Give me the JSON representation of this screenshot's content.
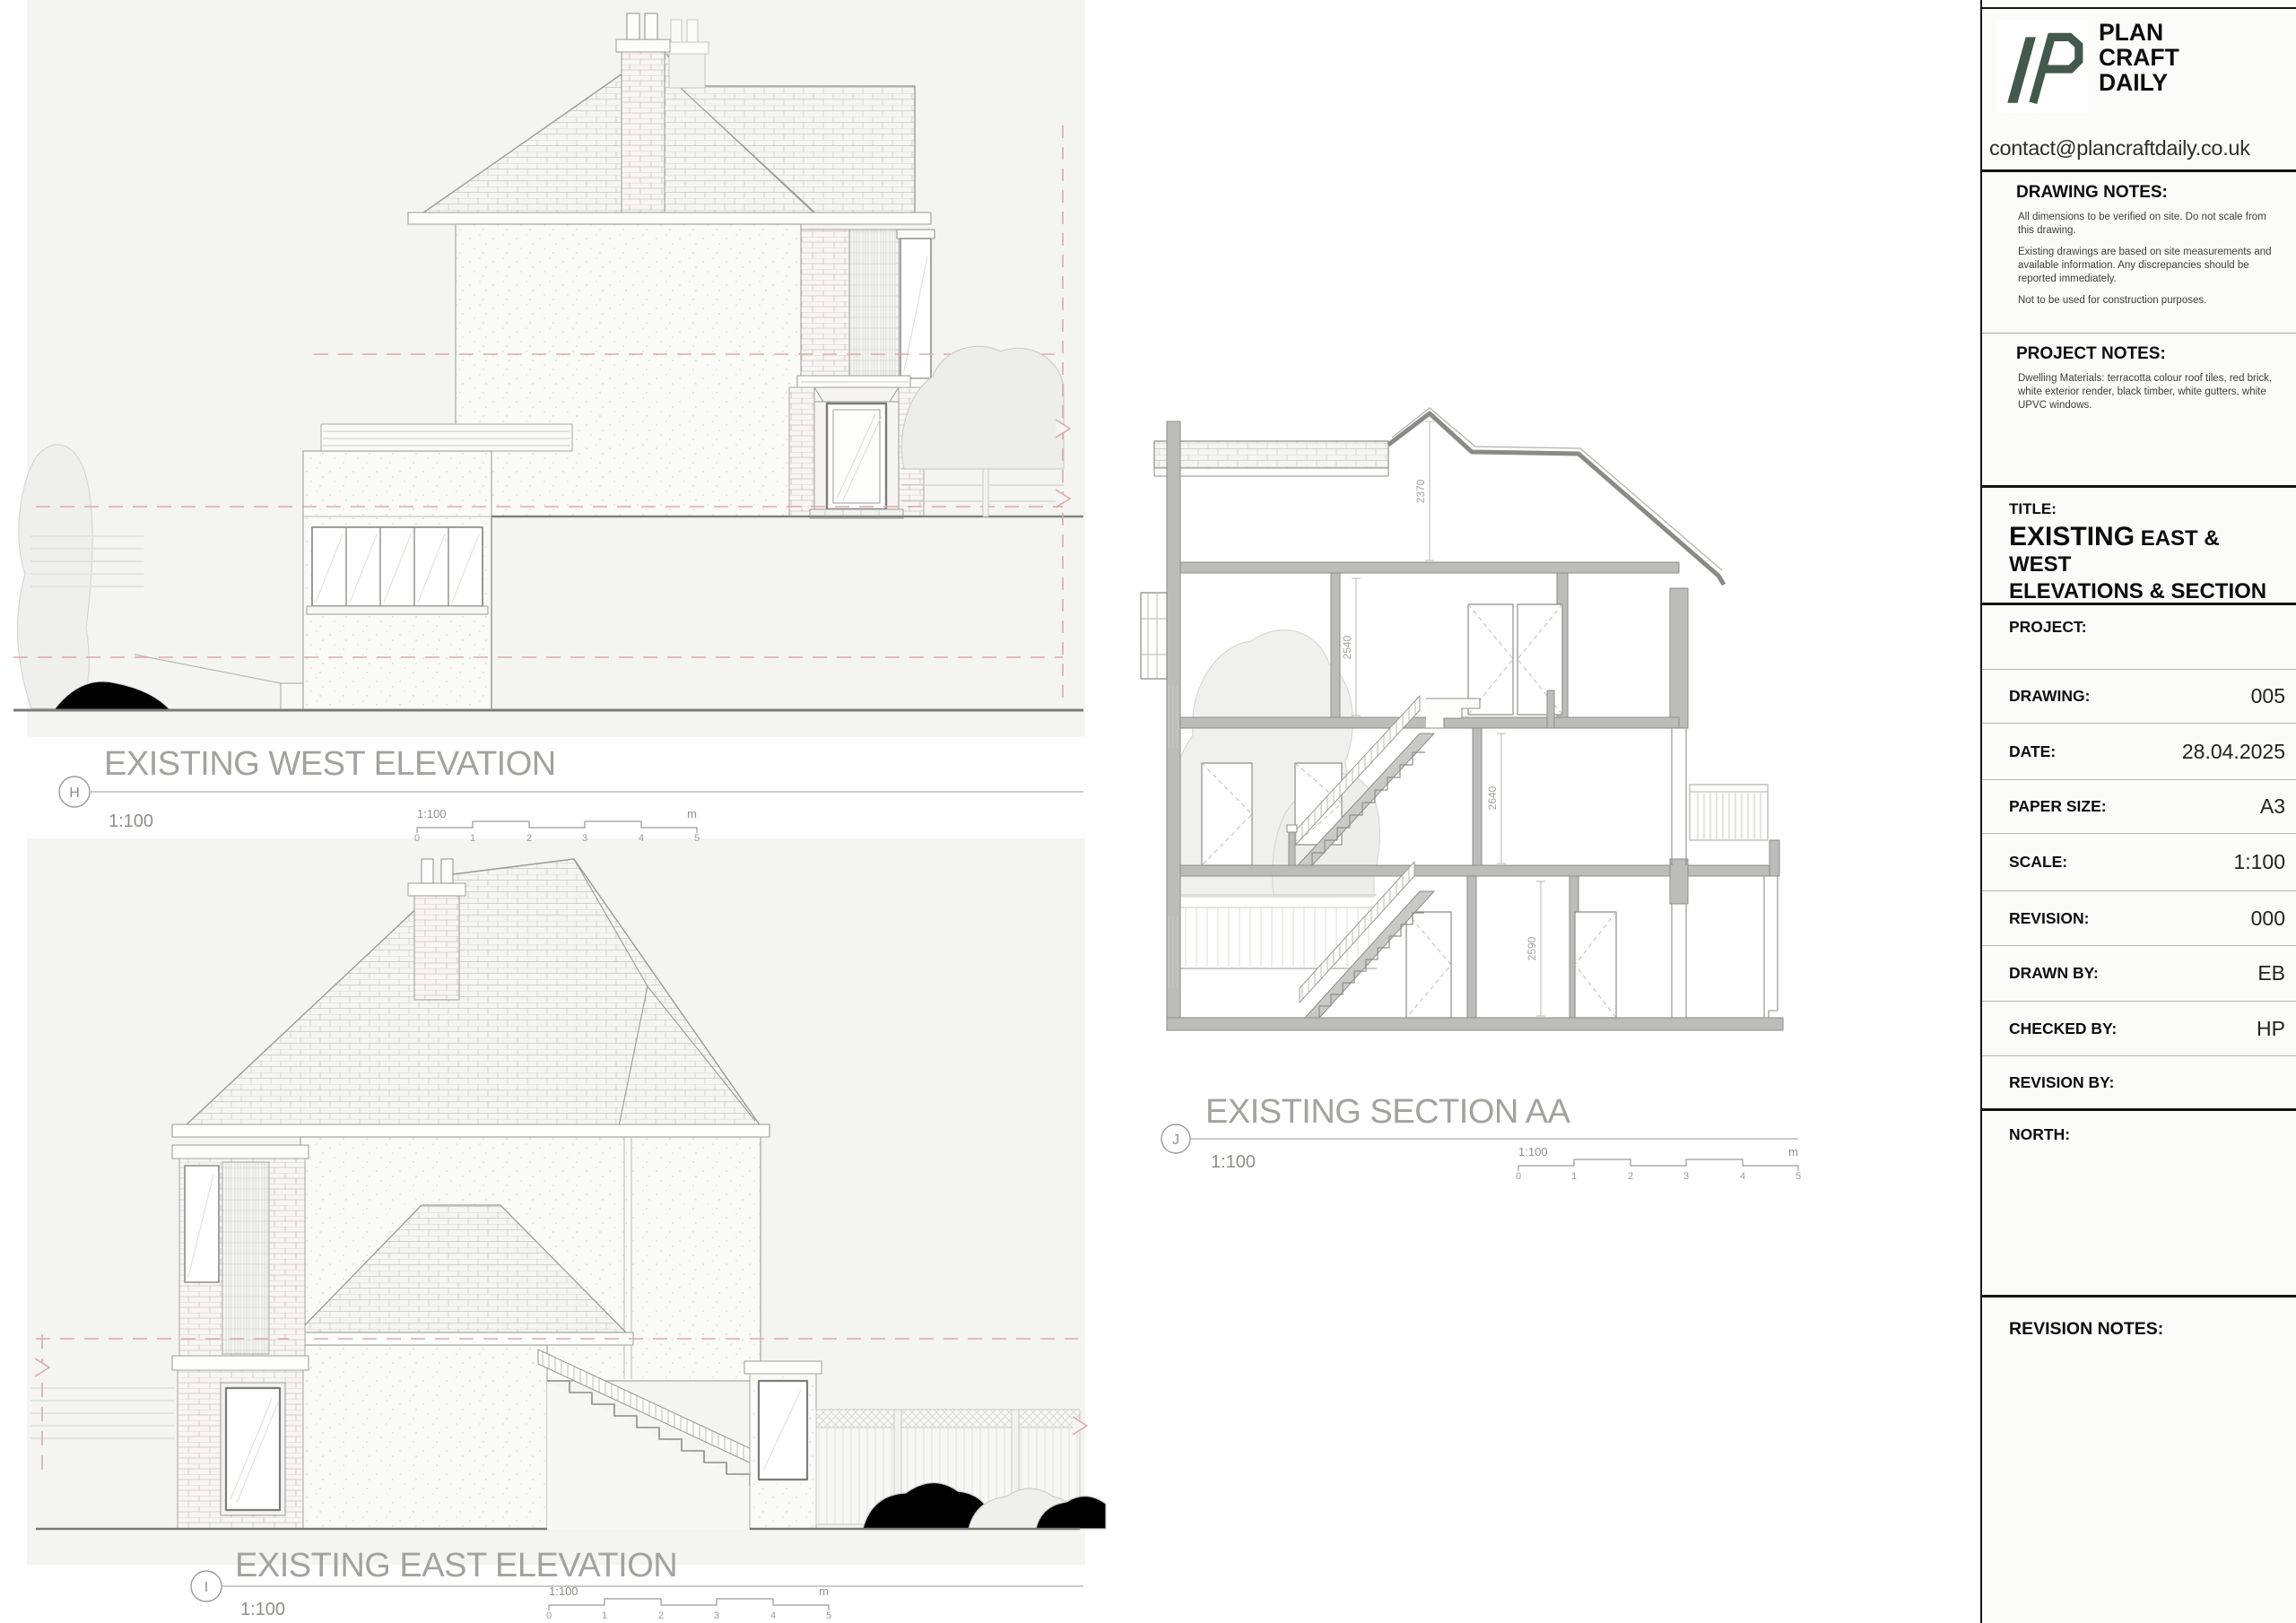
{
  "panel": {
    "brand": {
      "name_lines": [
        "PLAN",
        "CRAFT",
        "DAILY"
      ],
      "email": "contact@plancraftdaily.co.uk",
      "logo_color": "#42594b"
    },
    "drawing_notes": {
      "heading": "DRAWING NOTES:",
      "paragraphs": [
        "All dimensions to be verified on site. Do not scale from this drawing.",
        "Existing drawings are based on site measurements and available information. Any discrepancies should be reported immediately.",
        "Not to be used for construction purposes."
      ]
    },
    "project_notes": {
      "heading": "PROJECT NOTES:",
      "paragraphs": [
        "Dwelling Materials: terracotta colour roof tiles, red brick, white exterior render, black timber, white gutters, white UPVC windows."
      ]
    },
    "title_block": {
      "label": "TITLE:",
      "title_strong": "EXISTING",
      "title_rest": " EAST & WEST",
      "title_line2": "ELEVATIONS & SECTION"
    },
    "fields": [
      {
        "label": "PROJECT:",
        "value": ""
      },
      {
        "label": "DRAWING:",
        "value": "005"
      },
      {
        "label": "DATE:",
        "value": "28.04.2025"
      },
      {
        "label": "PAPER SIZE:",
        "value": "A3"
      },
      {
        "label": "SCALE:",
        "value": "1:100"
      },
      {
        "label": "REVISION:",
        "value": "000"
      },
      {
        "label": "DRAWN BY:",
        "value": "EB"
      },
      {
        "label": "CHECKED BY:",
        "value": "HP"
      },
      {
        "label": "REVISION BY:",
        "value": ""
      }
    ],
    "north_label": "NORTH:",
    "revision_notes_label": "REVISION NOTES:"
  },
  "drawings": {
    "west": {
      "ref": "H",
      "title": "EXISTING WEST ELEVATION",
      "scale": "1:100"
    },
    "east": {
      "ref": "I",
      "title": "EXISTING EAST ELEVATION",
      "scale": "1:100"
    },
    "section": {
      "ref": "J",
      "title": "EXISTING SECTION AA",
      "scale": "1:100"
    }
  },
  "scalebar": {
    "label": "1:100",
    "unit": "m",
    "ticks": [
      "0",
      "1",
      "2",
      "3",
      "4",
      "5"
    ]
  },
  "section_dims": [
    "2370",
    "2540",
    "2640",
    "2590"
  ],
  "colors": {
    "brand_green": "#42594b",
    "level_dash_red": "#dcaaaa",
    "drawing_bg": "#f4f4f1"
  }
}
